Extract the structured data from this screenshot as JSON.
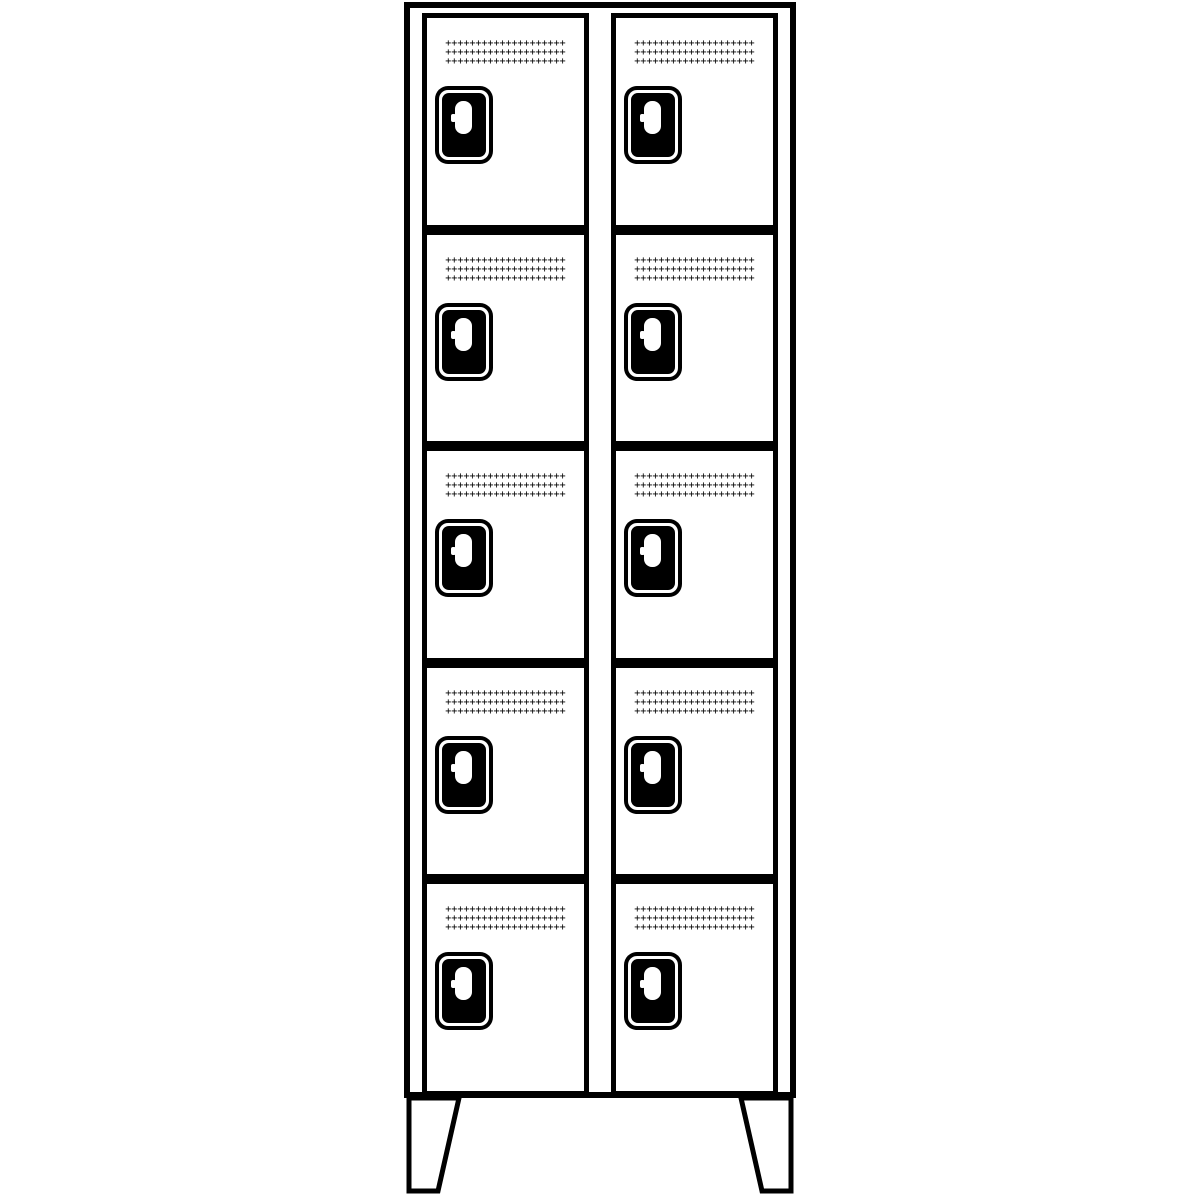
{
  "page": {
    "width": 1200,
    "height": 1200,
    "background": "#ffffff"
  },
  "drawing": {
    "subject": "cloakroom-compartment-locker-line-drawing",
    "line_color": "#000000",
    "body_fill": "#ffffff",
    "lock_plate_color": "#000000",
    "columns": 2,
    "rows_per_column": 5,
    "total_compartments": 10,
    "feet_count": 2,
    "grille": {
      "rows": 3,
      "cols": 20,
      "glyph": "+"
    },
    "compartments": [
      {
        "id": "compartment-1",
        "column": 1,
        "row": 1
      },
      {
        "id": "compartment-2",
        "column": 1,
        "row": 2
      },
      {
        "id": "compartment-3",
        "column": 1,
        "row": 3
      },
      {
        "id": "compartment-4",
        "column": 1,
        "row": 4
      },
      {
        "id": "compartment-5",
        "column": 1,
        "row": 5
      },
      {
        "id": "compartment-6",
        "column": 2,
        "row": 1
      },
      {
        "id": "compartment-7",
        "column": 2,
        "row": 2
      },
      {
        "id": "compartment-8",
        "column": 2,
        "row": 3
      },
      {
        "id": "compartment-9",
        "column": 2,
        "row": 4
      },
      {
        "id": "compartment-10",
        "column": 2,
        "row": 5
      }
    ]
  }
}
